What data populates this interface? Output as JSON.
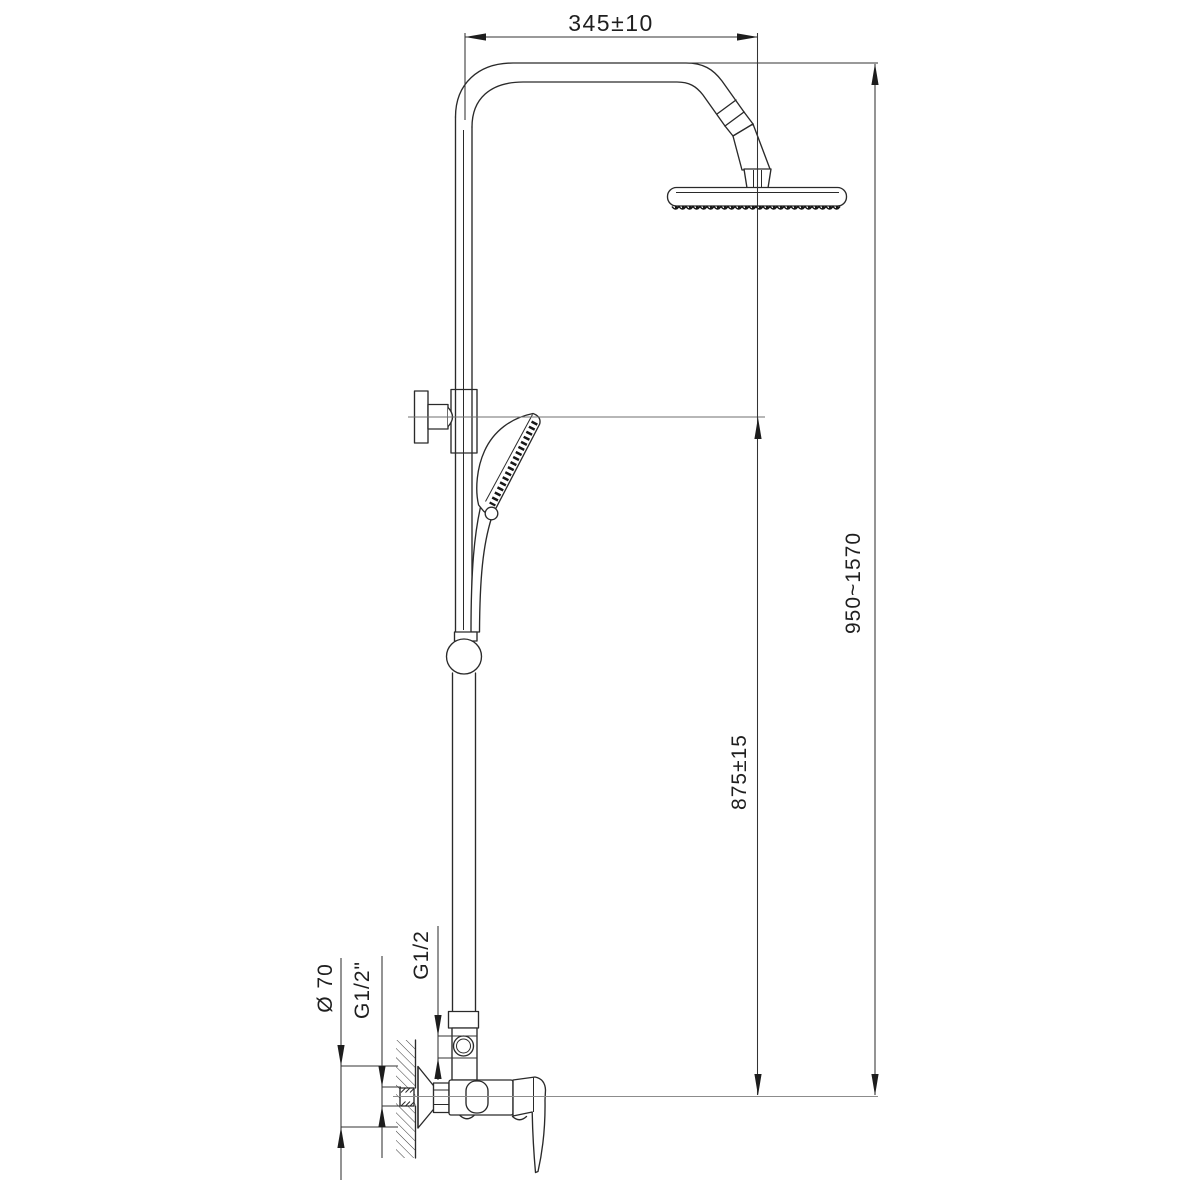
{
  "drawing": {
    "type": "technical-dimension-drawing",
    "colors": {
      "background": "#ffffff",
      "line": "#2a2a2a",
      "centerline": "#8c8c8c"
    },
    "dimensions": {
      "top_width": "345±10",
      "overall_height": "950~1570",
      "mid_height": "875±15",
      "escutcheon_diameter": "Ø 70",
      "wall_thread": "G1/2\"",
      "riser_thread": "G1/2"
    }
  }
}
